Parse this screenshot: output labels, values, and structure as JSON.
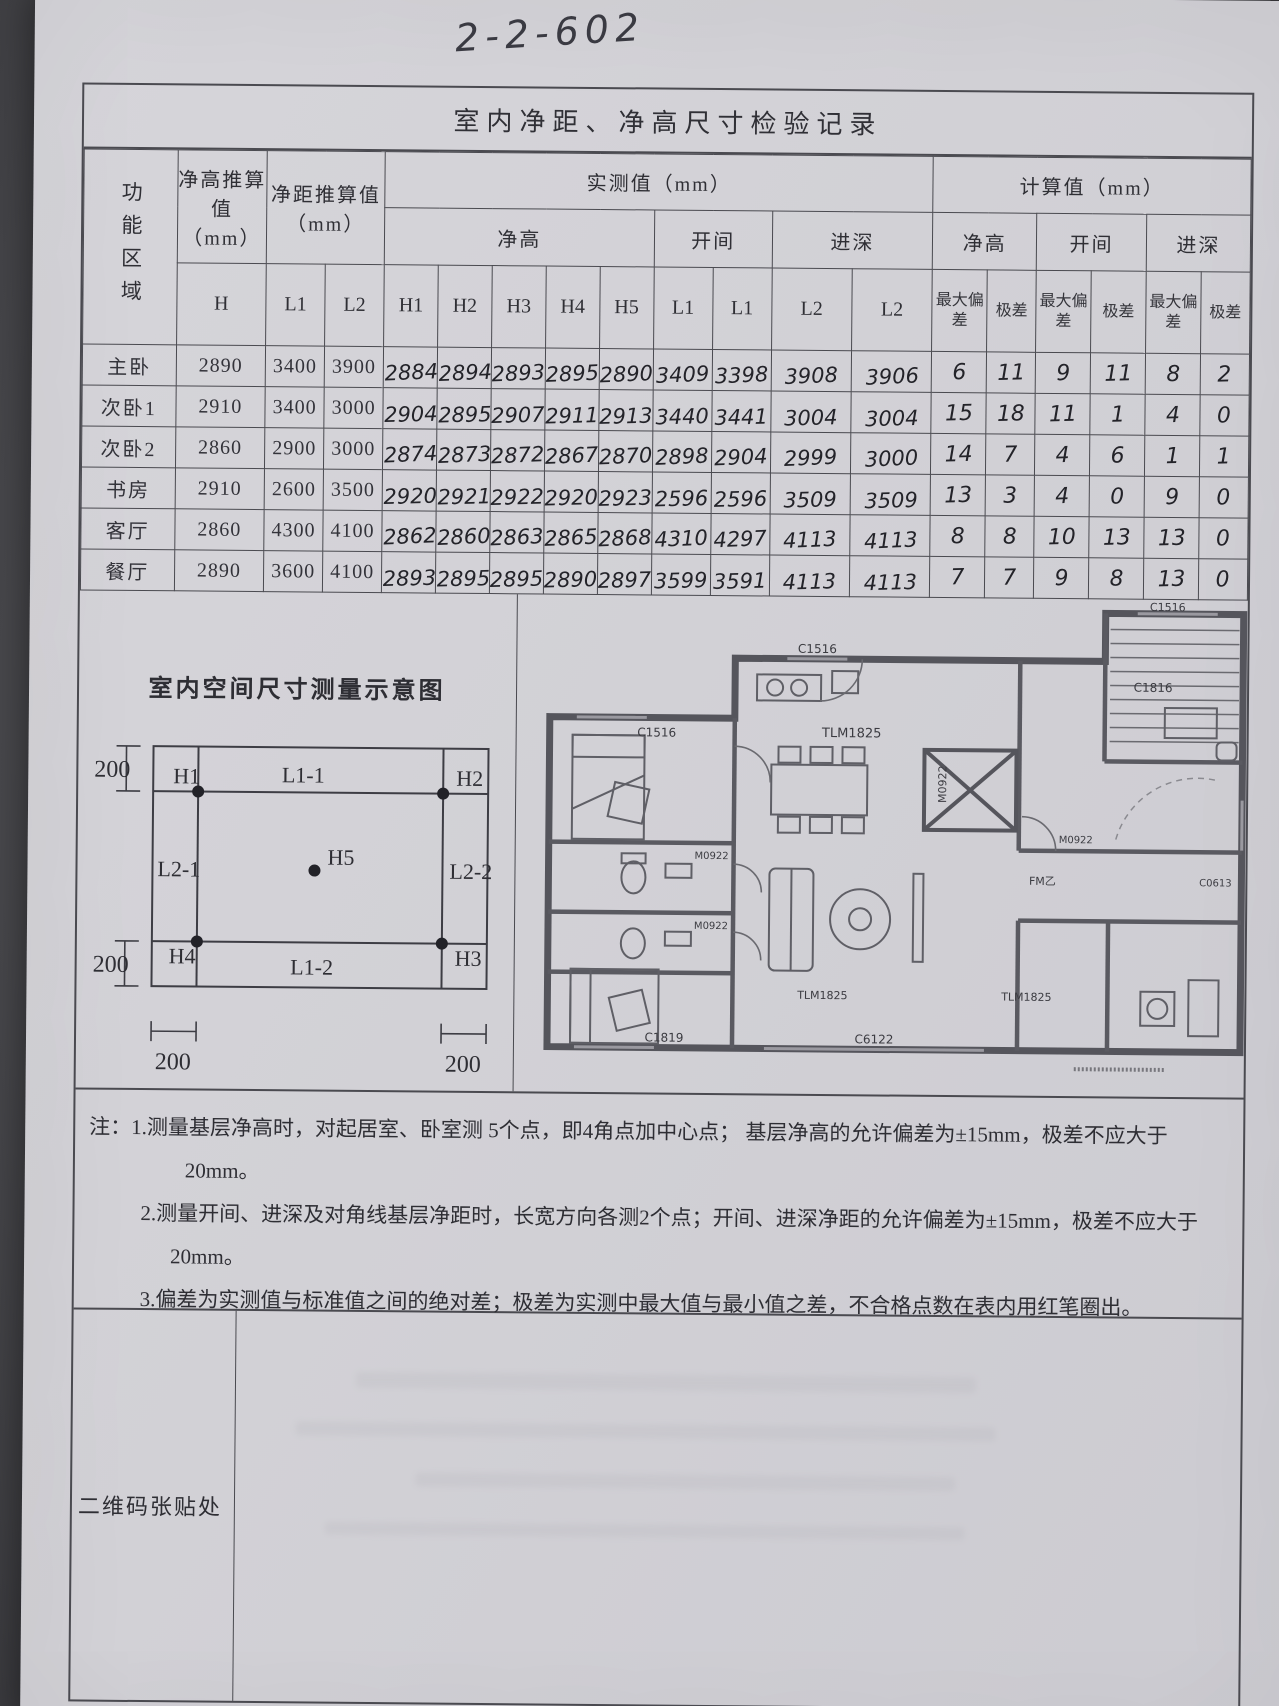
{
  "doc_number": "2-2-602",
  "form_title": "室内净距、净高尺寸检验记录",
  "table": {
    "header": {
      "area": "功能区域",
      "h_est": "净高推算值（mm）",
      "l_est": "净距推算值（mm）",
      "measured": "实测值（mm）",
      "calculated": "计算值（mm）",
      "clear_height": "净高",
      "bay_width": "开间",
      "depth": "进深",
      "h": "H",
      "l1": "L1",
      "l2": "L2",
      "h1": "H1",
      "h2": "H2",
      "h3": "H3",
      "h4": "H4",
      "h5": "H5",
      "max_dev": "最大偏差",
      "range": "极差"
    },
    "rows": [
      {
        "area": "主卧",
        "h": "2890",
        "l1": "3400",
        "l2": "3900",
        "hv": [
          "2884",
          "2894",
          "2893",
          "2895",
          "2890"
        ],
        "kj": [
          "3409",
          "3398"
        ],
        "js": [
          "3908",
          "3906"
        ],
        "calc": [
          "6",
          "11",
          "9",
          "11",
          "8",
          "2"
        ]
      },
      {
        "area": "次卧1",
        "h": "2910",
        "l1": "3400",
        "l2": "3000",
        "hv": [
          "2904",
          "2895",
          "2907",
          "2911",
          "2913"
        ],
        "kj": [
          "3440",
          "3441"
        ],
        "js": [
          "3004",
          "3004"
        ],
        "calc": [
          "15",
          "18",
          "11",
          "1",
          "4",
          "0"
        ]
      },
      {
        "area": "次卧2",
        "h": "2860",
        "l1": "2900",
        "l2": "3000",
        "hv": [
          "2874",
          "2873",
          "2872",
          "2867",
          "2870"
        ],
        "kj": [
          "2898",
          "2904"
        ],
        "js": [
          "2999",
          "3000"
        ],
        "calc": [
          "14",
          "7",
          "4",
          "6",
          "1",
          "1"
        ]
      },
      {
        "area": "书房",
        "h": "2910",
        "l1": "2600",
        "l2": "3500",
        "hv": [
          "2920",
          "2921",
          "2922",
          "2920",
          "2923"
        ],
        "kj": [
          "2596",
          "2596"
        ],
        "js": [
          "3509",
          "3509"
        ],
        "calc": [
          "13",
          "3",
          "4",
          "0",
          "9",
          "0"
        ]
      },
      {
        "area": "客厅",
        "h": "2860",
        "l1": "4300",
        "l2": "4100",
        "hv": [
          "2862",
          "2860",
          "2863",
          "2865",
          "2868"
        ],
        "kj": [
          "4310",
          "4297"
        ],
        "js": [
          "4113",
          "4113"
        ],
        "calc": [
          "8",
          "8",
          "10",
          "13",
          "13",
          "0"
        ]
      },
      {
        "area": "餐厅",
        "h": "2890",
        "l1": "3600",
        "l2": "4100",
        "hv": [
          "2893",
          "2895",
          "2895",
          "2890",
          "2897"
        ],
        "kj": [
          "3599",
          "3591"
        ],
        "js": [
          "4113",
          "4113"
        ],
        "calc": [
          "7",
          "7",
          "9",
          "8",
          "13",
          "0"
        ]
      }
    ]
  },
  "diagram": {
    "title": "室内空间尺寸测量示意图",
    "h1": "H1",
    "h2": "H2",
    "h3": "H3",
    "h4": "H4",
    "h5": "H5",
    "l11": "L1-1",
    "l12": "L1-2",
    "l21": "L2-1",
    "l22": "L2-2",
    "dim": "200"
  },
  "plan": {
    "labels": {
      "c1516_top": "C1516",
      "c1516_stair": "C1516",
      "c1516_bedroom": "C1516",
      "c1816": "C1816",
      "tlm1825_dining": "TLM1825",
      "m0922_vertical": "M0922",
      "m0922_bath1": "M0922",
      "m0922_bath2": "M0922",
      "m0922_hall": "M0922",
      "fm": "FM乙",
      "c0613": "C0613",
      "c1819": "C1819",
      "c6122": "C6122",
      "tlm1825_living": "TLM1825",
      "tlm1825_balcony": "TLM1825"
    }
  },
  "notes": {
    "n1": "注：1.测量基层净高时，对起居室、卧室测 5个点，即4角点加中心点；  基层净高的允许偏差为±15mm，极差不应大于 20mm。",
    "n2": "2.测量开间、进深及对角线基层净距时，长宽方向各测2个点；开间、进深净距的允许偏差为±15mm，极差不应大于 20mm。",
    "n3": "3.偏差为实测值与标准值之间的绝对差；极差为实测中最大值与最小值之差，不合格点数在表内用红笔圈出。"
  },
  "qr_label": "二维码张贴处"
}
